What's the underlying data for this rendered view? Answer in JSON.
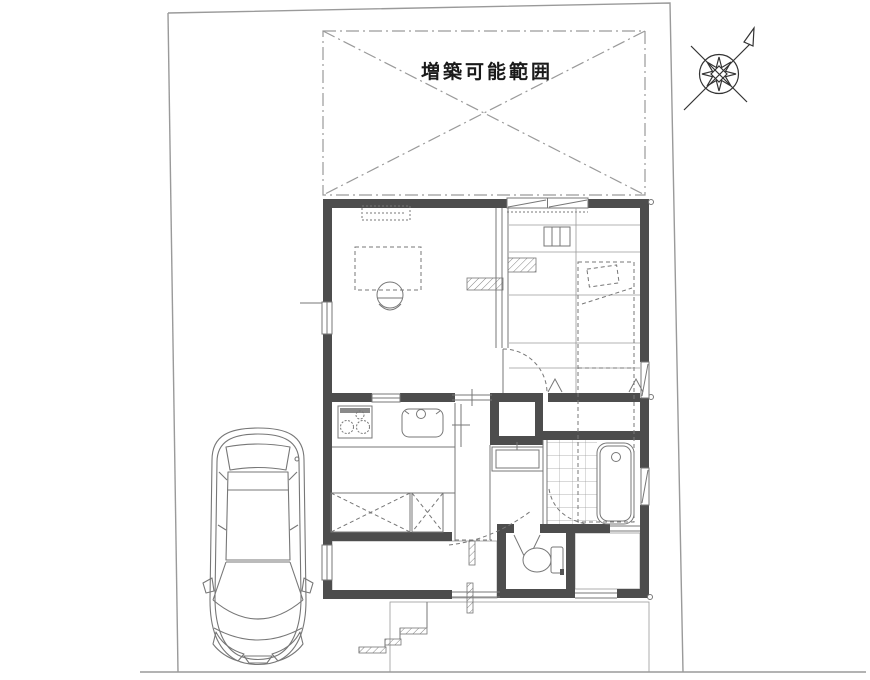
{
  "plan": {
    "extension_label": "増築可能範囲"
  },
  "colors": {
    "wall": "#4d4d4d",
    "line": "#777777",
    "boundary": "#9a9a9a",
    "text": "#1a1a1a",
    "tile": "#9a9a9a",
    "hatch": "#666666"
  },
  "symbols": [
    "north-compass-icon",
    "car-top-view",
    "extension-area-cross",
    "dining-table",
    "chair",
    "air-conditioner-dashed",
    "bed",
    "pillow",
    "closet-cross-large",
    "closet-cross-small",
    "storage-box",
    "stove",
    "kitchen-sink",
    "washbasin",
    "bathtub",
    "toilet",
    "door-swing-arc",
    "folding-door",
    "sliding-window",
    "entrance-steps",
    "tile-floor",
    "new-wall-hatch"
  ]
}
